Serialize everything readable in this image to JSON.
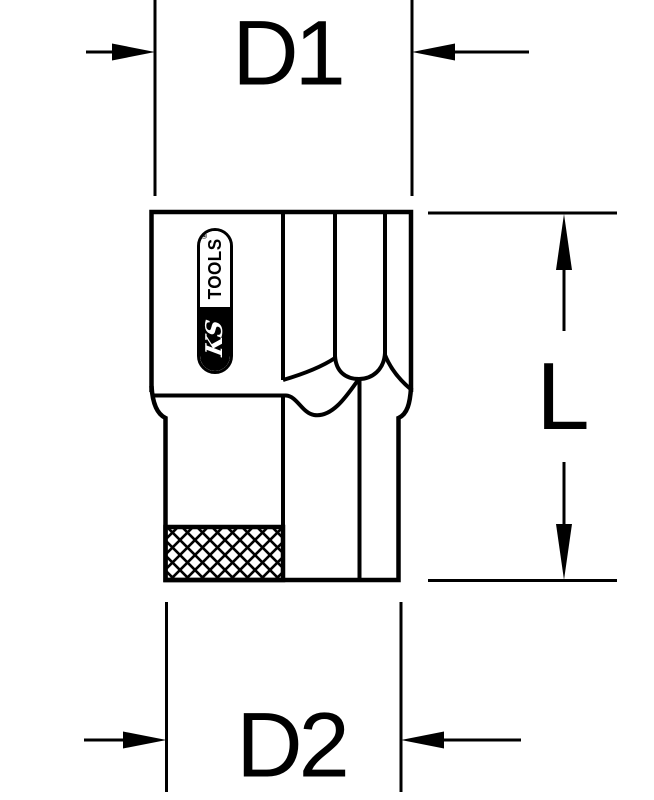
{
  "diagram": {
    "background_color": "#ffffff",
    "line_color": "#000000",
    "dimension_labels": {
      "width_top": "D1",
      "width_bottom": "D2",
      "length_right": "L"
    },
    "brand_logo": {
      "script_text": "KS",
      "block_text": "TOOLS",
      "registered_mark": "®"
    }
  }
}
